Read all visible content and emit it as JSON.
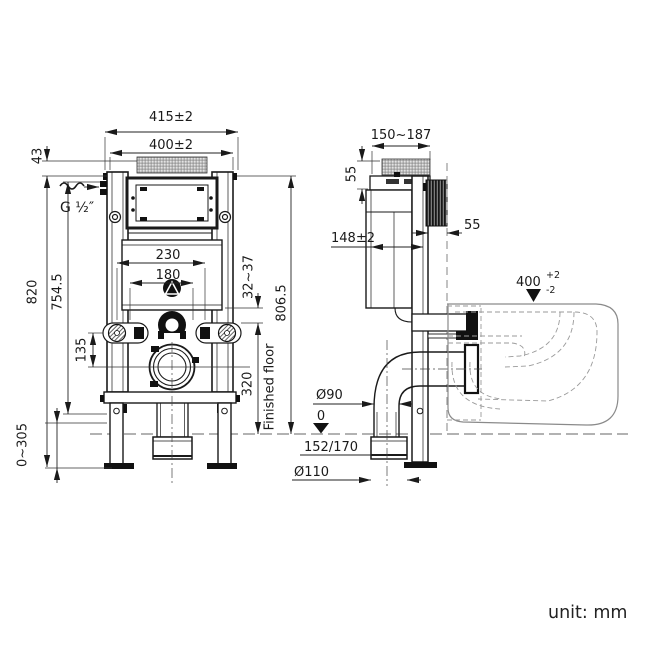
{
  "unit_note": "unit: mm",
  "colors": {
    "ink": "#1a1a1a",
    "toilet_outline": "#8a8a8a"
  },
  "front": {
    "width_outer": "415±2",
    "width_inner": "400±2",
    "top_offset": "43",
    "height_total": "820",
    "height_inlet": "754.5",
    "leg_adjust": "0~305",
    "bolt_span_wide": "230",
    "bolt_span_narrow": "180",
    "axis_offset": "135",
    "water_inlet": "G ½″",
    "stud_protrusion": "32~37",
    "height_front": "806.5",
    "flush_pipe_height": "320",
    "floor_label": "Finished floor"
  },
  "side": {
    "depth_adjust": "150~187",
    "plate_height": "55",
    "frame_depth": "148±2",
    "wall_gap": "55",
    "rim_height": "400",
    "rim_tol_plus": "+2",
    "rim_tol_minus": "-2",
    "elbow_dia": "Ø90",
    "floor_zero": "0",
    "outlet_heights": "152/170",
    "drain_dia": "Ø110"
  }
}
